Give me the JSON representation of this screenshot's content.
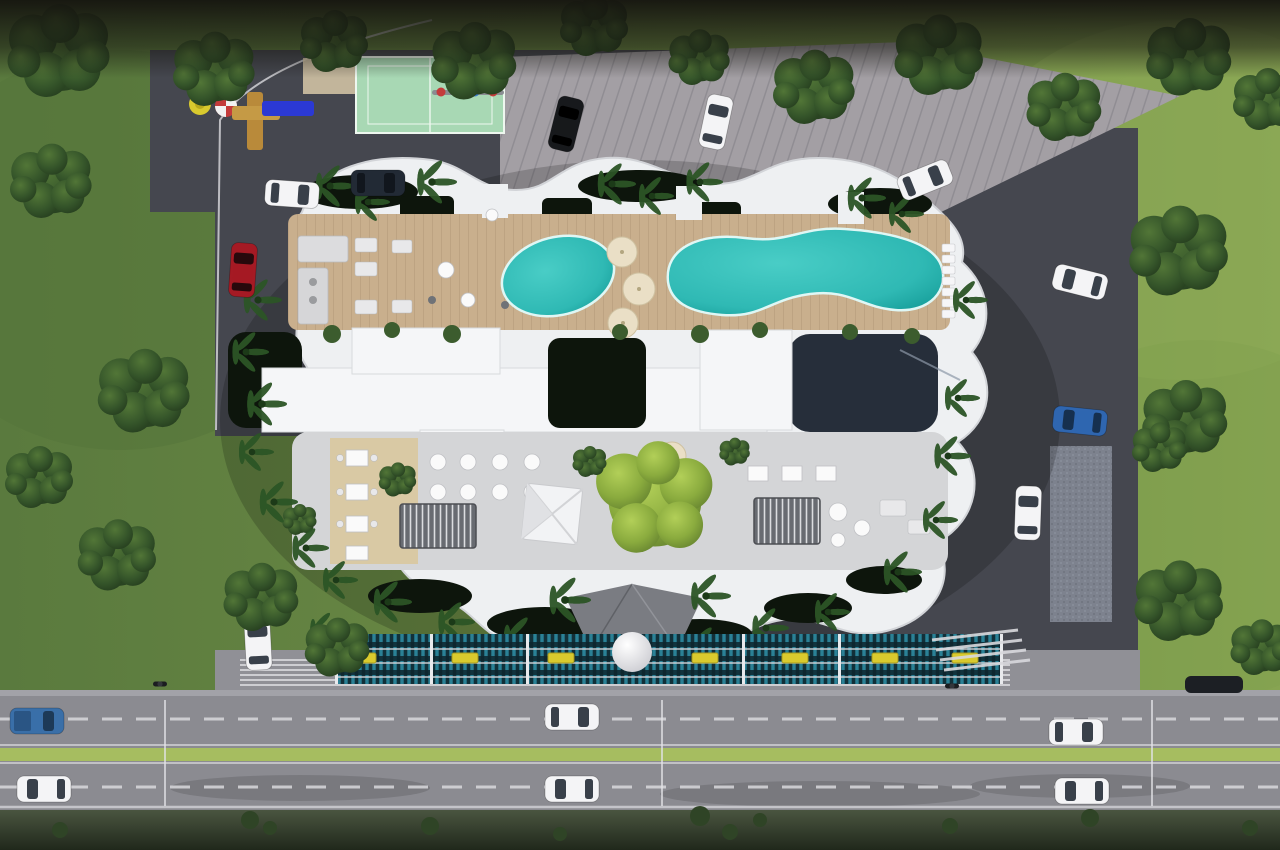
{
  "scene": {
    "type": "architectural-aerial-render",
    "view": "top-down site plan of a residential condo complex beside a divided road",
    "elements": [
      "scalloped white residential building",
      "rooftop wood amenity deck",
      "oval pool",
      "kidney-shaped pool",
      "deck umbrellas",
      "sun loungers",
      "mint sports court",
      "children playground",
      "ribbed parking deck",
      "asphalt drive",
      "central courtyard with dining tables and pergolas",
      "large bright courtyard tree",
      "white event canopy",
      "street-facing teal louver fence with yellow planter boxes",
      "entry canopy with white sphere sculpture",
      "divided road with green median",
      "lawns with trees and palms"
    ]
  },
  "colors": {
    "grass-left": "#5a7a3e",
    "grass-right": "#87a452",
    "pavement-dark": "#45474f",
    "parking-deck": "#a39fa4",
    "road": "#8b8b91",
    "median": "#a6bd60",
    "sidewalk": "#909096",
    "building-white": "#eef0f2",
    "roof-white": "#f5f6f8",
    "deck-wood": "#c9af8d",
    "pool-teal": "#2fb9b4",
    "pool-deep": "#169d99",
    "court-green": "#a8d8b4",
    "fence-teal": "#2a8196",
    "fence-dark": "#123039",
    "flower-yellow": "#d9ca2e",
    "planter-dark": "#0d150c",
    "tree-dark": "#2d4a25",
    "tree-light": "#8aab3e",
    "umbrella-cream": "#eadfc6",
    "canopy-gray": "#7a7c82",
    "car-white": "#f4f4f6",
    "car-black": "#17191c",
    "car-red": "#a51a24",
    "car-blue": "#2f66b0",
    "car-navy": "#222a35",
    "glass": "#39404a",
    "line-white": "#d9d9dd"
  },
  "vehicles": {
    "site": [
      {
        "name": "black-suv-top-parking"
      },
      {
        "name": "white-sedan-top-parking"
      },
      {
        "name": "white-sedan-upper-drive"
      },
      {
        "name": "white-car-left-curve"
      },
      {
        "name": "navy-car-left-curve"
      },
      {
        "name": "red-car-left-edge"
      },
      {
        "name": "white-van-right-drive"
      },
      {
        "name": "blue-car-right-drive"
      },
      {
        "name": "white-car-lower-right"
      },
      {
        "name": "white-car-entrance"
      }
    ],
    "road": [
      {
        "name": "blue-pickup-westbound"
      },
      {
        "name": "white-sedan-westbound-1"
      },
      {
        "name": "white-sedan-westbound-2"
      },
      {
        "name": "white-sedan-eastbound-1"
      },
      {
        "name": "white-sedan-eastbound-2"
      },
      {
        "name": "white-sedan-eastbound-3"
      },
      {
        "name": "motorcycle-near-entrance"
      },
      {
        "name": "motorcycle-east"
      }
    ]
  },
  "counts": {
    "pools": 2,
    "deck-umbrellas": 3,
    "courtyard-umbrellas": 3,
    "sun-loungers": 7,
    "fence-flower-boxes": 7,
    "road-light-poles": 3
  }
}
